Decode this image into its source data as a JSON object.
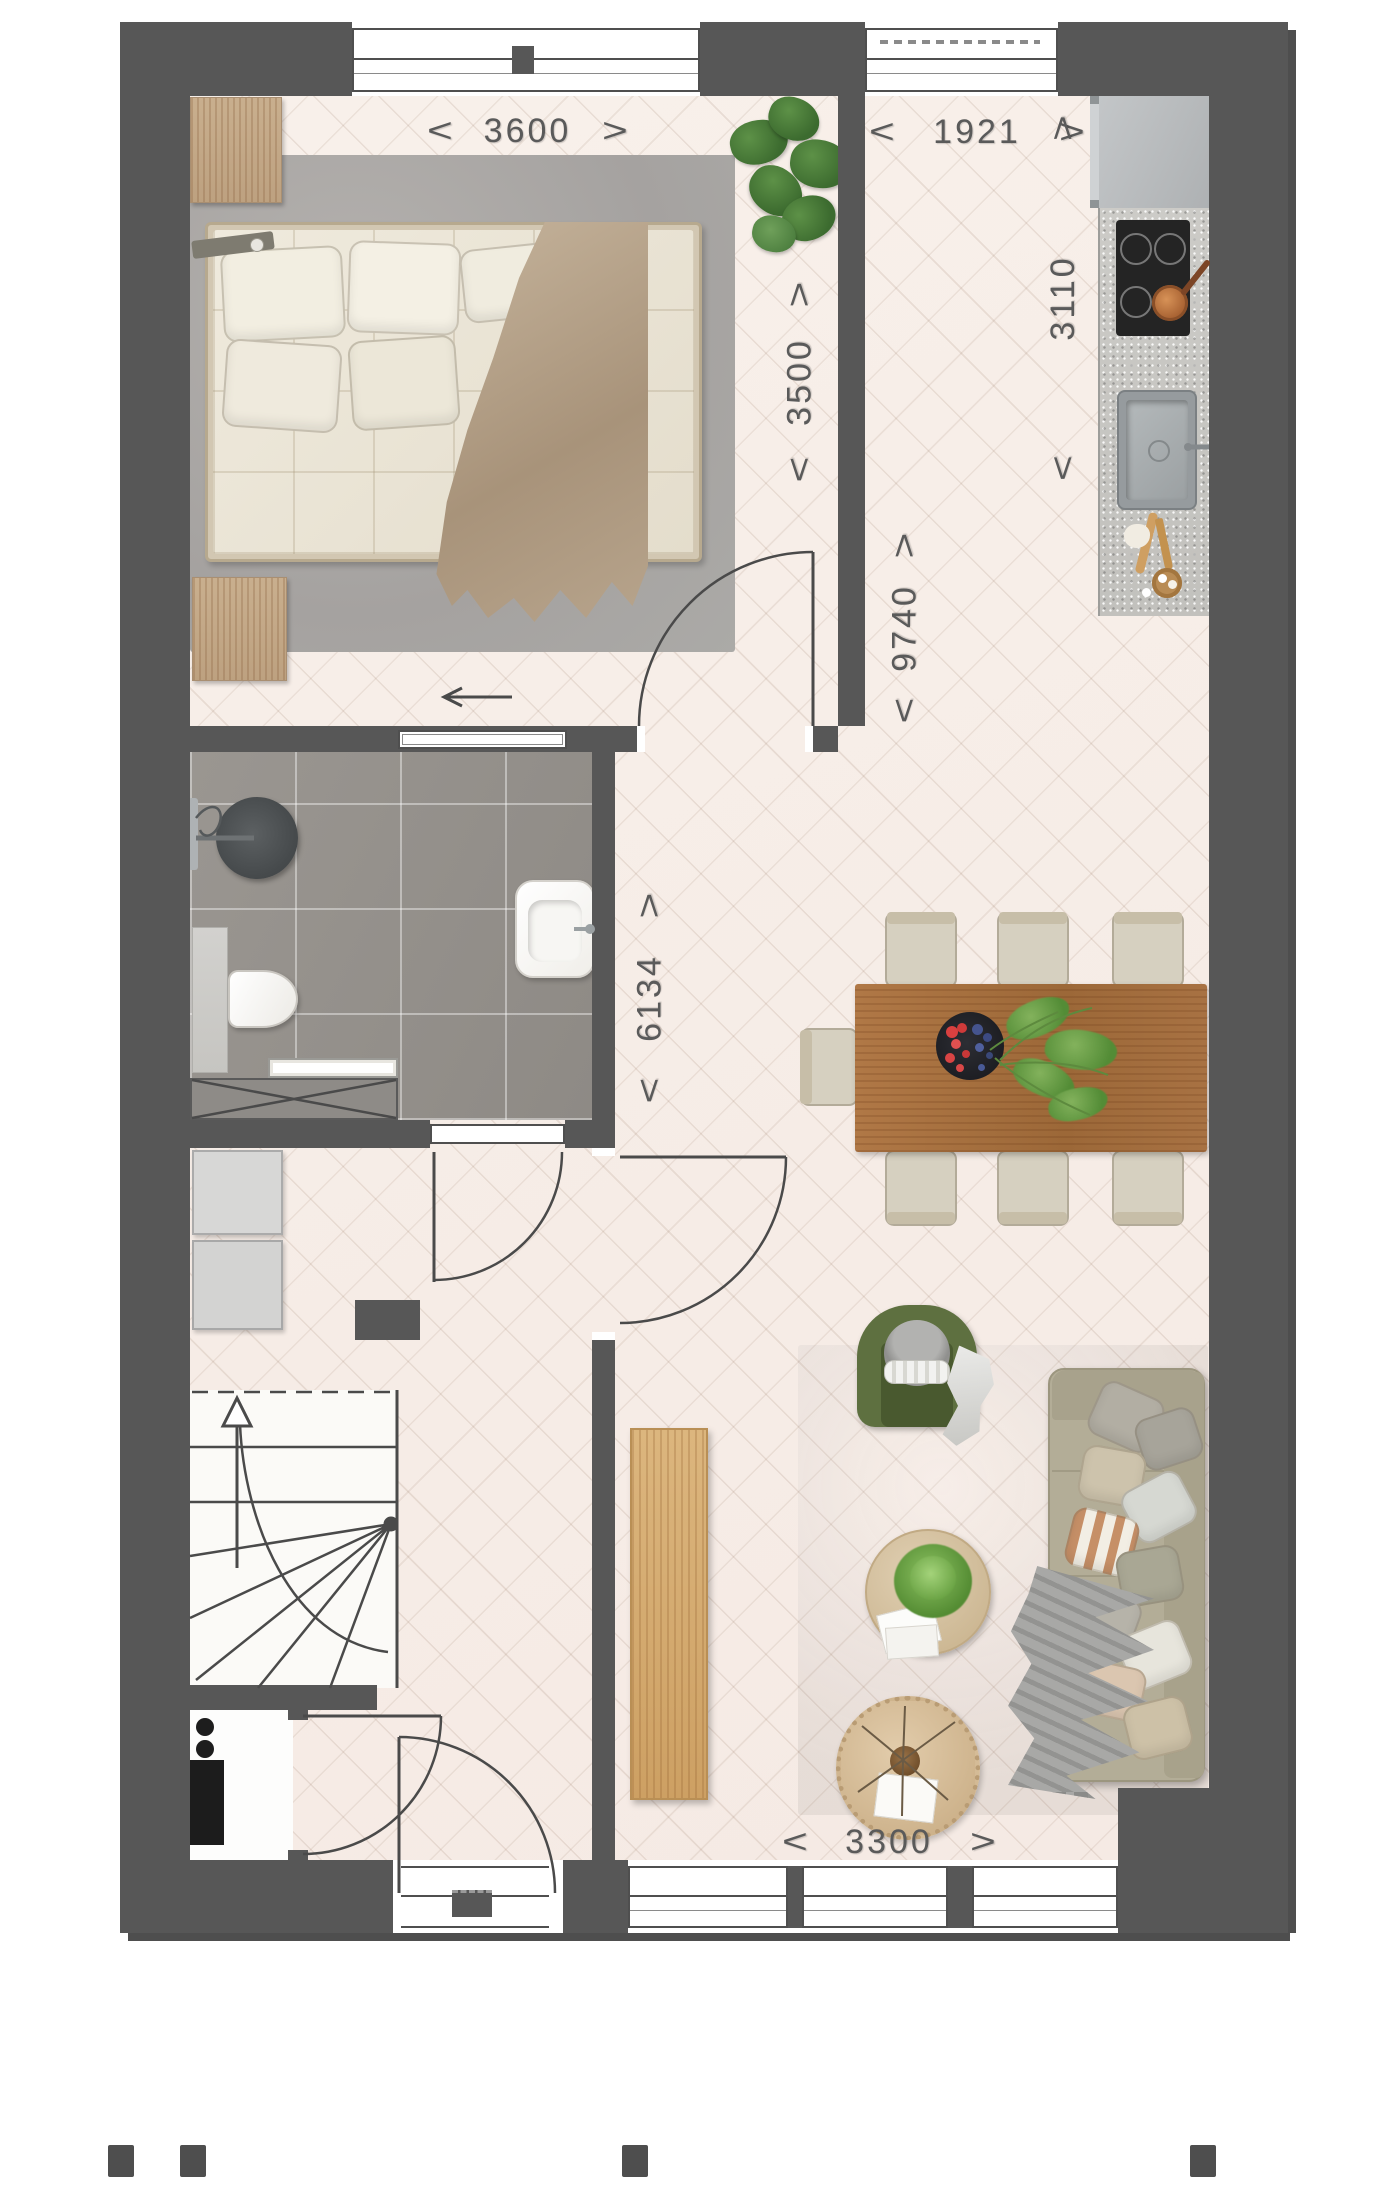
{
  "dimensions": {
    "arrow_left": "<",
    "arrow_right": ">",
    "bedroom_width_mm": "3600",
    "kitchen_corridor_width_mm": "1921",
    "bedroom_depth_mm": "3500",
    "kitchen_zone_depth_mm": "3110",
    "total_interior_depth_mm": "9740",
    "living_zone_depth_mm": "6134",
    "living_width_mm": "3300"
  },
  "colors": {
    "wall": "#575757",
    "floor": "#f7eee8",
    "bathroom_tile": "#95918d",
    "bedroom_rug": "#adaaa7",
    "living_rug": "#a99d8e",
    "sofa": "#b3ad97",
    "armchair_green": "#5e7040",
    "dining_table_wood": "#a97141",
    "sideboard_wood": "#d8ae74",
    "counter_granite": "#c9c8c4",
    "dimension_text": "#5a5a5a"
  }
}
